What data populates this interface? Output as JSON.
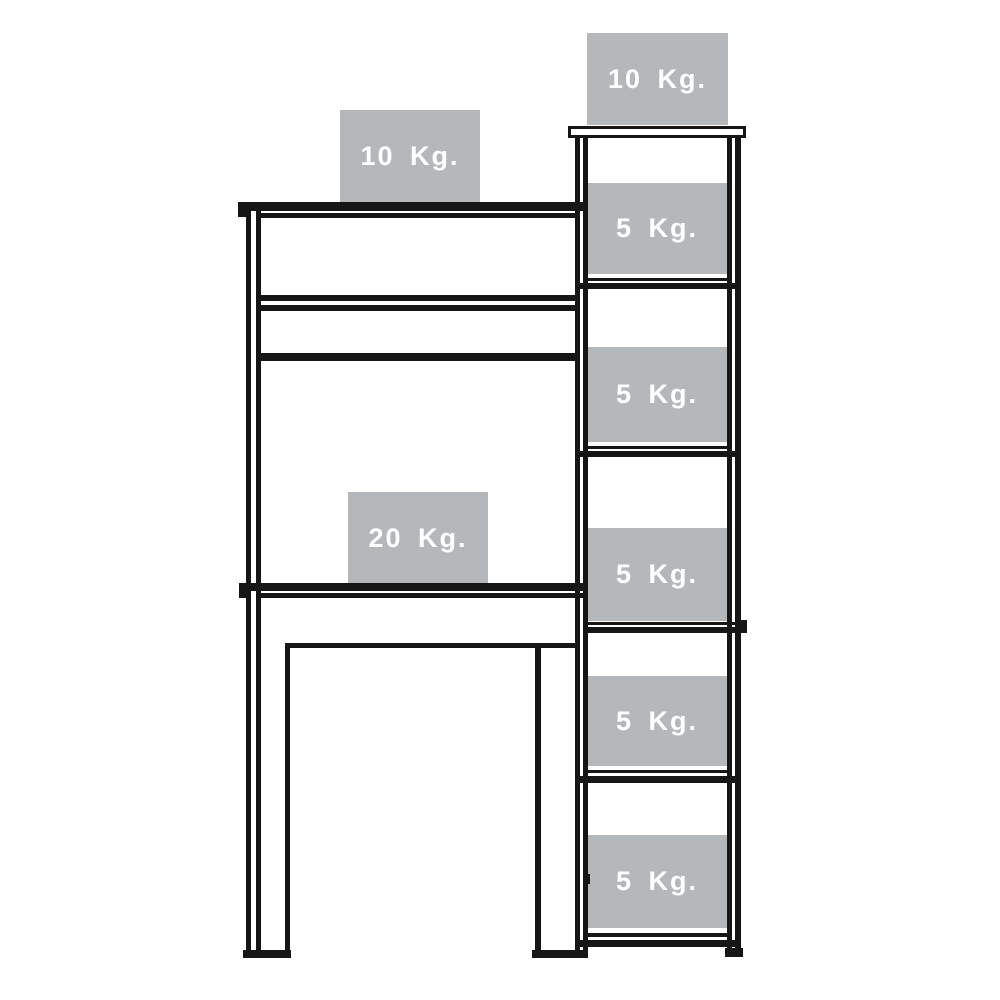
{
  "diagram": {
    "type": "furniture-weight-capacity-diagram",
    "colors": {
      "background": "#ffffff",
      "line": "#161616",
      "label_box": "#b5b8bb",
      "label_text": "#ffffff"
    },
    "desk": {
      "hutch_top_label": "10 Kg.",
      "desktop_label": "20 Kg."
    },
    "shelf_unit": {
      "top_label": "10 Kg.",
      "shelf_labels": [
        "5 Kg.",
        "5 Kg.",
        "5 Kg.",
        "5 Kg.",
        "5 Kg."
      ]
    }
  }
}
